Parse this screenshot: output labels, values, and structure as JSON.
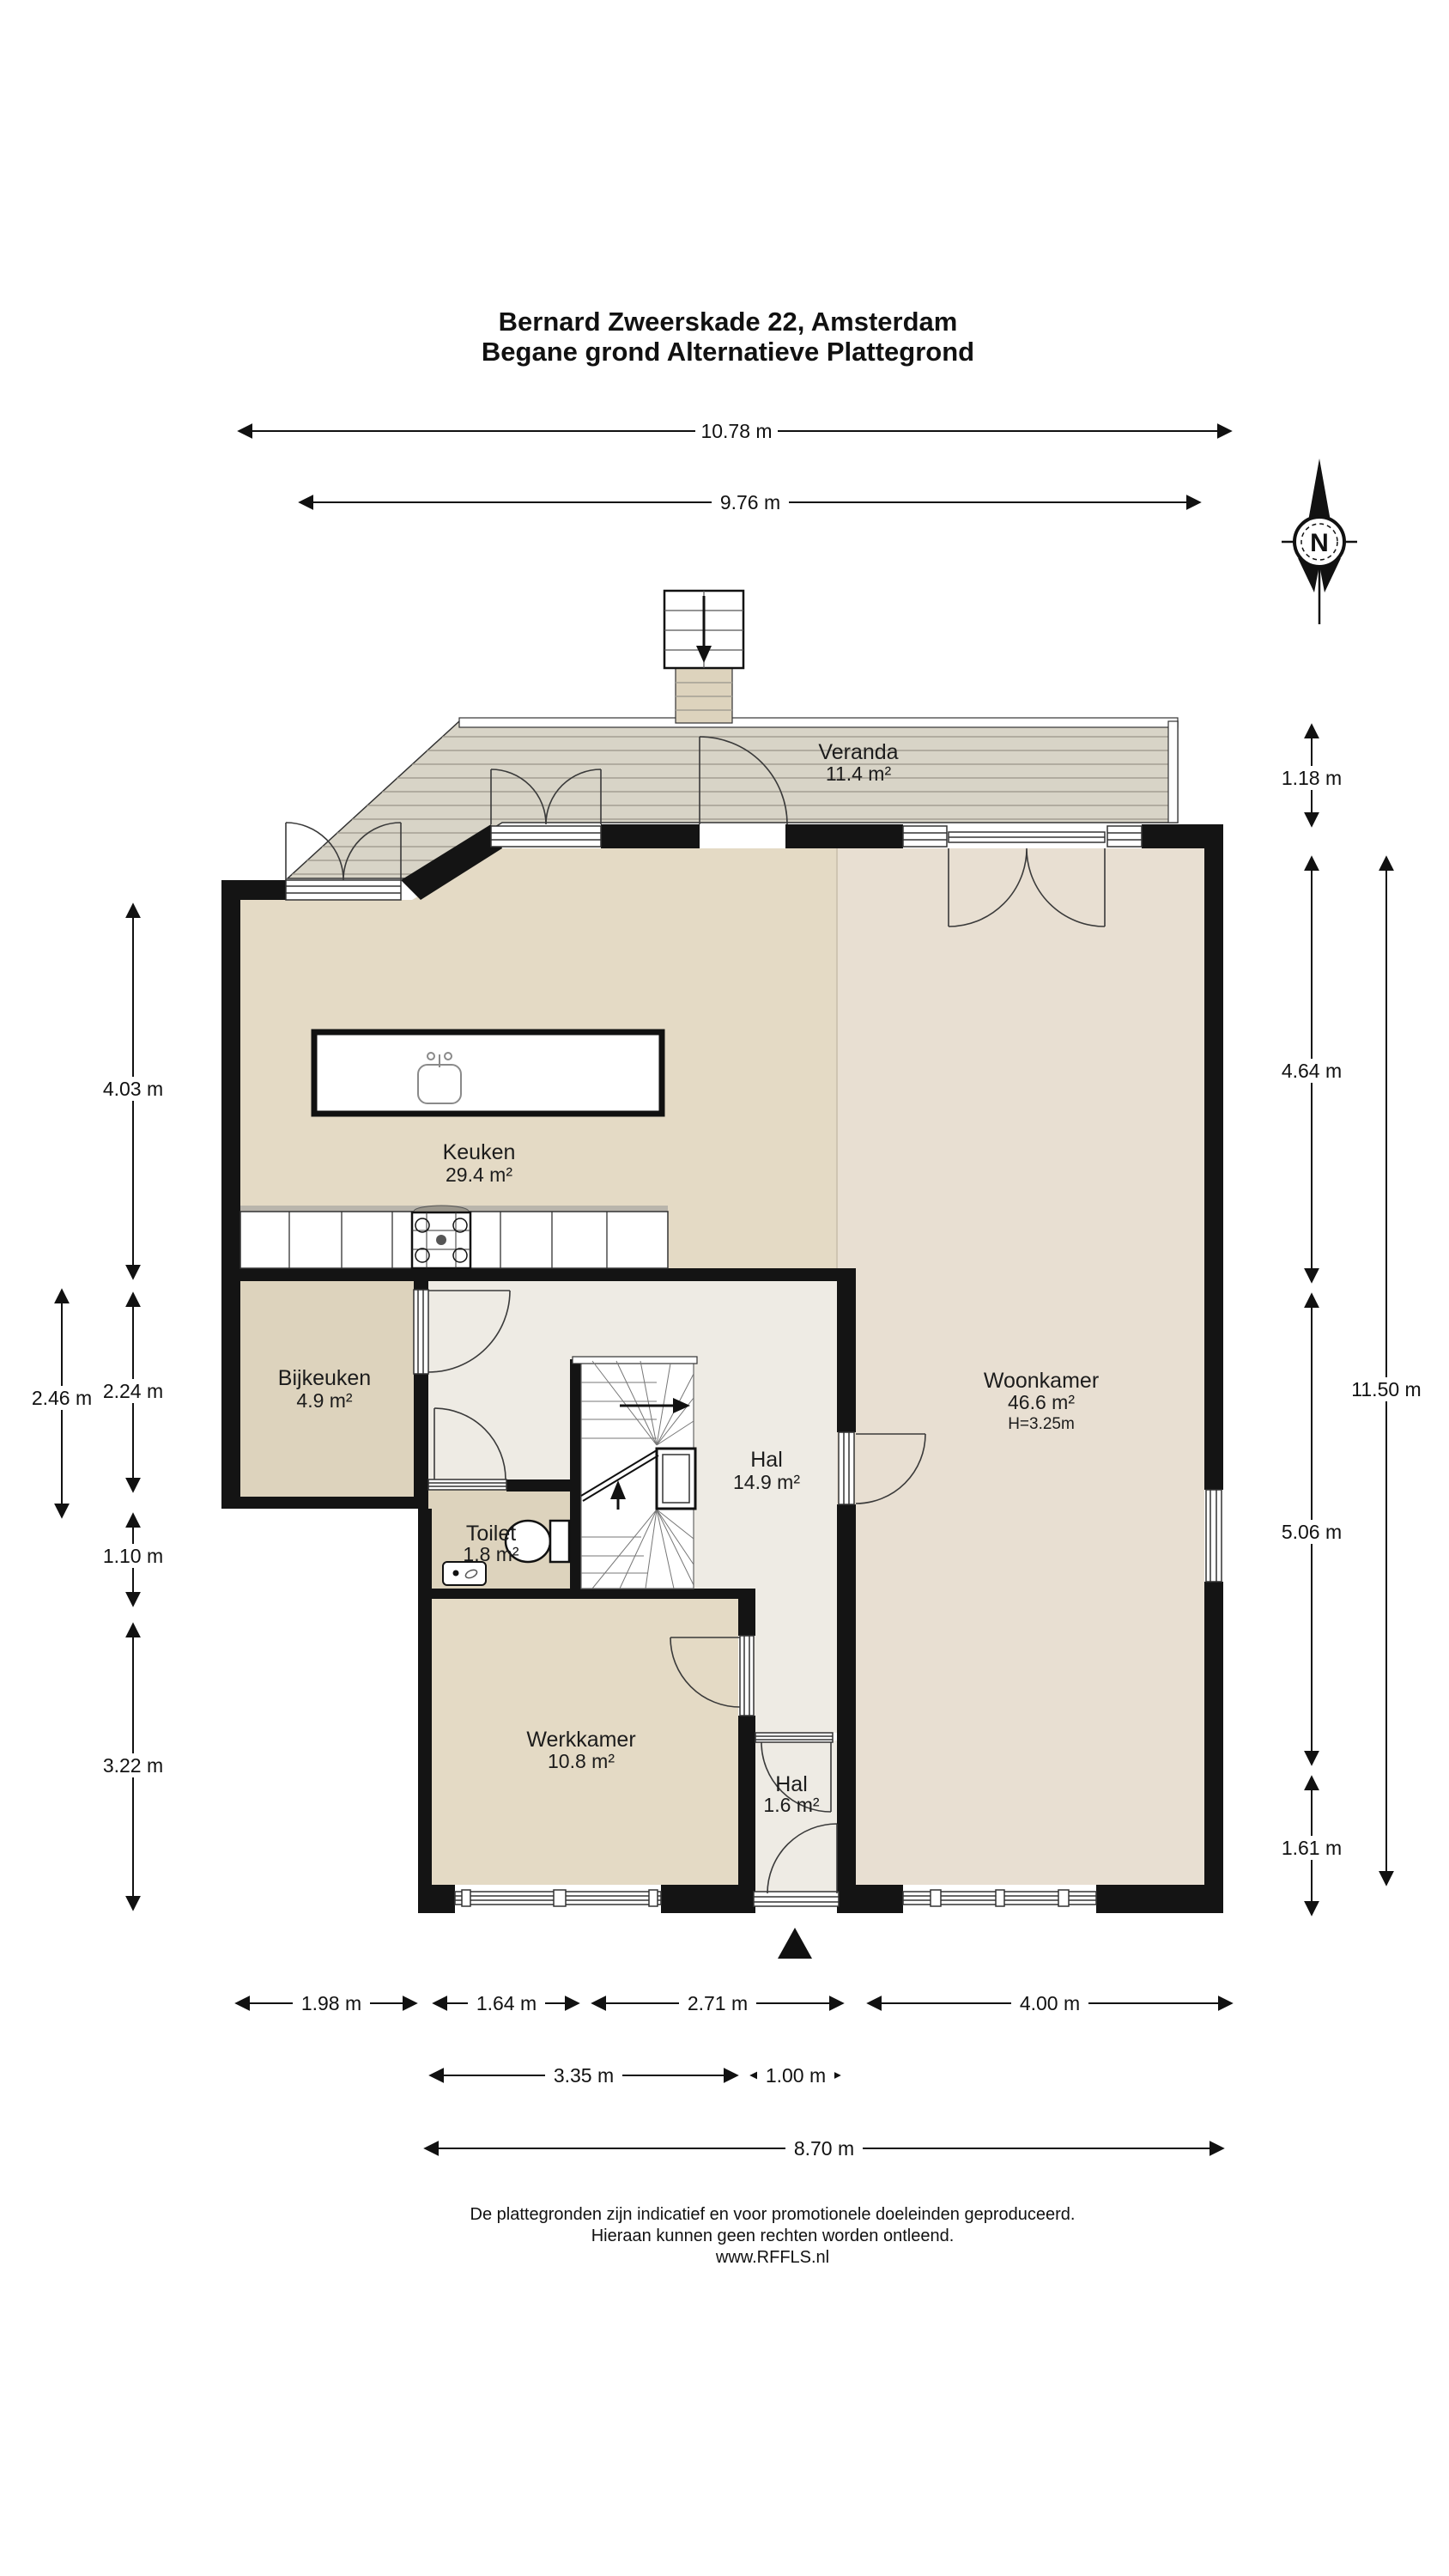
{
  "title": {
    "line1": "Bernard Zweerskade 22, Amsterdam",
    "line2": "Begane grond Alternatieve Plattegrond"
  },
  "compass": {
    "label": "N"
  },
  "rooms": [
    {
      "name": "Veranda",
      "area": "11.4 m²"
    },
    {
      "name": "Keuken",
      "area": "29.4 m²"
    },
    {
      "name": "Bijkeuken",
      "area": "4.9 m²"
    },
    {
      "name": "Hal",
      "area": "14.9 m²"
    },
    {
      "name": "Toilet",
      "area": "1.8 m²"
    },
    {
      "name": "Woonkamer",
      "area": "46.6 m²",
      "height": "H=3.25m"
    },
    {
      "name": "Werkkamer",
      "area": "10.8 m²"
    },
    {
      "name": "Hal",
      "area": "1.6 m²"
    }
  ],
  "dims": {
    "top": [
      {
        "label": "10.78 m"
      },
      {
        "label": "9.76 m"
      }
    ],
    "left": [
      {
        "label": "4.03 m"
      },
      {
        "label": "2.46 m"
      },
      {
        "label": "2.24 m"
      },
      {
        "label": "1.10 m"
      },
      {
        "label": "3.22 m"
      }
    ],
    "right": [
      {
        "label": "1.18 m"
      },
      {
        "label": "4.64 m"
      },
      {
        "label": "11.50 m"
      },
      {
        "label": "5.06 m"
      },
      {
        "label": "1.61 m"
      }
    ],
    "bottom": [
      {
        "label": "1.98 m"
      },
      {
        "label": "1.64 m"
      },
      {
        "label": "2.71 m"
      },
      {
        "label": "4.00 m"
      },
      {
        "label": "3.35 m"
      },
      {
        "label": "1.00 m"
      },
      {
        "label": "8.70 m"
      }
    ]
  },
  "footer": {
    "line1": "De plattegronden zijn indicatief en voor promotionele doeleinden geproduceerd.",
    "line2": "Hieraan kunnen geen rechten worden ontleend.",
    "line3": "www.RFFLS.nl"
  },
  "colors": {
    "wall": "#141414",
    "floor_keuken": "#e4dac5",
    "floor_bijkeuken": "#ddd3bd",
    "floor_woonkamer": "#e8dfd2",
    "floor_hal": "#eeebe4",
    "deck": "#d8d4c7",
    "deck_stripe": "#a49f93",
    "line": "#333333"
  }
}
